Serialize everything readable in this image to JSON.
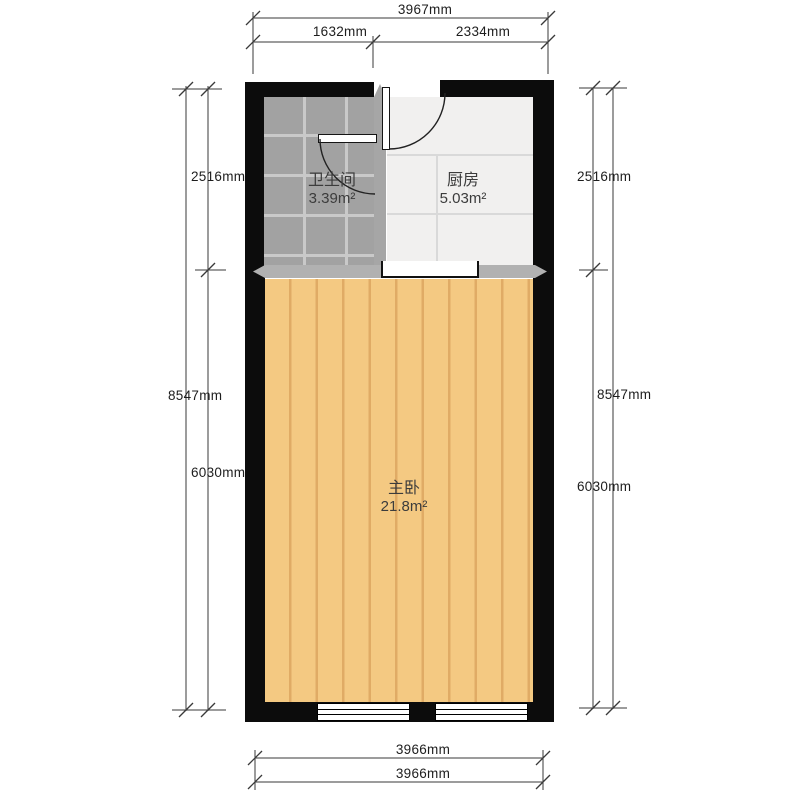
{
  "rooms": {
    "bathroom": {
      "name": "卫生间",
      "area": "3.39m²"
    },
    "kitchen": {
      "name": "厨房",
      "area": "5.03m²"
    },
    "bedroom": {
      "name": "主卧",
      "area": "21.8m²"
    }
  },
  "dimensions": {
    "top_total": "3967mm",
    "top_seg1": "1632mm",
    "top_seg2": "2334mm",
    "left_upper": "2516mm",
    "left_total": "8547mm",
    "left_lower": "6030mm",
    "right_upper": "2516mm",
    "right_total": "8547mm",
    "right_lower": "6030mm",
    "bottom_outer": "3966mm",
    "bottom_inner": "3966mm"
  },
  "colors": {
    "wall": "#0c0c0c",
    "bedroom_floor": "#f4c982",
    "bedroom_plank_line": "#e0ab65",
    "bathroom_tile": "#a2a2a2",
    "bathroom_grout": "#c9c9c9",
    "kitchen_tile": "#f1f0ef",
    "kitchen_line": "#d9d9d9",
    "partition_band": "#b1b1b1",
    "dimension_line": "#3a3a3a",
    "label_text": "#3c3c3c"
  }
}
